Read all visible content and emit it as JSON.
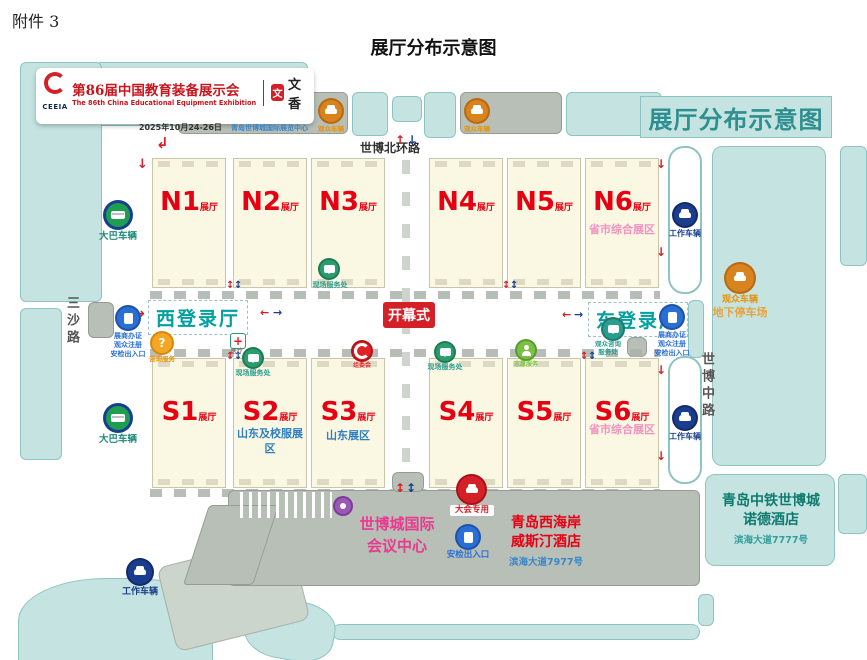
{
  "page": {
    "attachment": "附件 3",
    "title": "展厅分布示意图"
  },
  "banner": {
    "org": "CEEIA",
    "title_cn": "第86届中国教育装备展示会",
    "title_en": "The 86th China Educational Equipment Exhibition",
    "partner": "文香",
    "seal_char": "文",
    "date": "2025年10月24-26日",
    "venue": "青岛世博城国际展览中心"
  },
  "map": {
    "corner_title": "展厅分布示意图",
    "hall_suffix": "展厅",
    "roads": {
      "north": "世博北环路",
      "west": "三沙路",
      "east": "世博中路"
    },
    "center": {
      "west_hall": "西登录厅",
      "east_hall": "东登录厅",
      "opening": "开幕式"
    },
    "halls": {
      "N1": {
        "name": "N1"
      },
      "N2": {
        "name": "N2"
      },
      "N3": {
        "name": "N3"
      },
      "N4": {
        "name": "N4"
      },
      "N5": {
        "name": "N5"
      },
      "N6": {
        "name": "N6",
        "note1": "省市综合",
        "note2": "展区"
      },
      "S1": {
        "name": "S1"
      },
      "S2": {
        "name": "S2",
        "note1": "山东及校服",
        "note2": "展区"
      },
      "S3": {
        "name": "S3",
        "note1": "山东展区"
      },
      "S4": {
        "name": "S4"
      },
      "S5": {
        "name": "S5"
      },
      "S6": {
        "name": "S6",
        "note1": "省市综合",
        "note2": "展区"
      }
    },
    "gate": {
      "line1": "展商办证",
      "line2": "观众注册",
      "line3": "安检出入口"
    },
    "labels": {
      "visitor_vehicle": "观众车辆",
      "underground": "地下停车场",
      "coach": "大巴车辆",
      "staff": "工作车辆",
      "info": "咨询服务",
      "medical": "医疗",
      "service": "现场服务处",
      "committee": "组委会",
      "volunteer": "志愿服务",
      "east_service1": "观众咨询",
      "east_service2": "服务处",
      "conference_car": "大会专用",
      "security": "安检出入口"
    },
    "buildings": {
      "conference1": "世博城国际",
      "conference2": "会议中心",
      "westin1": "青岛西海岸",
      "westin2": "威斯汀酒店",
      "westin_addr": "滨海大道7977号",
      "nord1": "青岛中铁世博城",
      "nord2": "诺德酒店",
      "nord_addr": "滨海大道7777号"
    },
    "glyphs": {
      "up": "↑",
      "down": "↓",
      "left": "←",
      "right": "→",
      "updown": "↕",
      "elbow": "↲",
      "question": "?"
    }
  },
  "colors": {
    "teal_fill": "#c4e3e1",
    "accent_red": "#d42027",
    "hall_label_red": "#e60012",
    "reg_teal": "#00a0a0",
    "note_pink": "#f291c0",
    "note_blue": "#2f7fc1",
    "coach_green": "#1d9e50",
    "staff_navy": "#1a3e8f",
    "visitor_orange": "#d9831f",
    "gate_blue": "#2a6fd6"
  }
}
